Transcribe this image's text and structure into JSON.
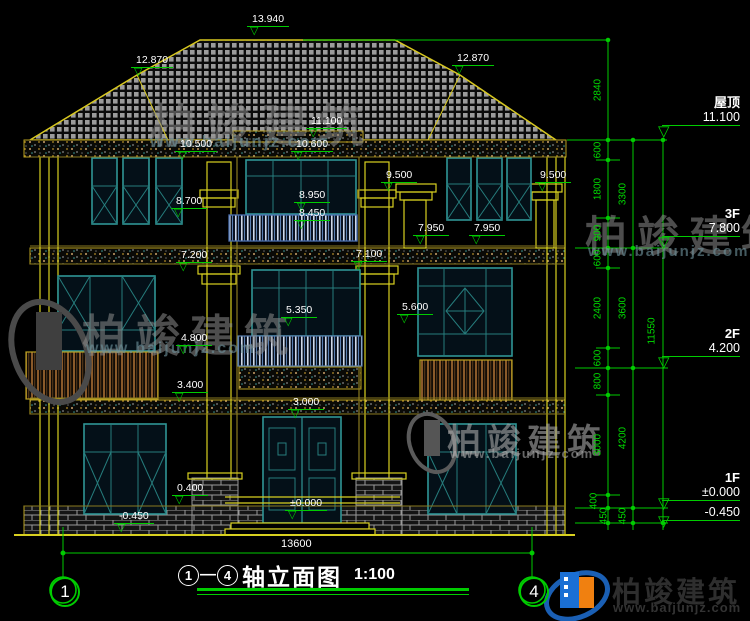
{
  "title": {
    "axis_left": "1",
    "axis_right": "4",
    "dash": "—",
    "name": "轴立面图",
    "scale": "1:100"
  },
  "axis_bubbles": {
    "left": "1",
    "right": "4"
  },
  "overall_dim": "13600",
  "building_markers": [
    "13.940",
    "12.870",
    "12.870",
    "11.100",
    "10.500",
    "10.600",
    "9.500",
    "9.500",
    "8.950",
    "8.450",
    "8.700",
    "7.950",
    "7.950",
    "7.200",
    "7.100",
    "5.600",
    "5.350",
    "4.800",
    "3.400",
    "3.000",
    "0.400",
    "±0.000",
    "-0.450"
  ],
  "right_levels": [
    {
      "label": "屋顶",
      "value": "11.100"
    },
    {
      "label": "3F",
      "value": "7.800"
    },
    {
      "label": "2F",
      "value": "4.200"
    },
    {
      "label": "1F",
      "value": "±0.000"
    },
    {
      "label": "",
      "value": "-0.450"
    }
  ],
  "dims_inner": [
    "2840",
    "600",
    "1800",
    "900",
    "600",
    "2400",
    "600",
    "800",
    "3000",
    "400",
    "450"
  ],
  "dims_mid": [
    "3300",
    "3600",
    "4200",
    "450"
  ],
  "dims_outer": [
    "11550"
  ],
  "brand": {
    "name": "柏竣建筑",
    "url": "www.baijunjz.com"
  },
  "colors": {
    "line_yellow": "#d8d020",
    "dim_green": "#00cc00",
    "frame_teal": "#2f9595",
    "text": "#ffffff"
  }
}
